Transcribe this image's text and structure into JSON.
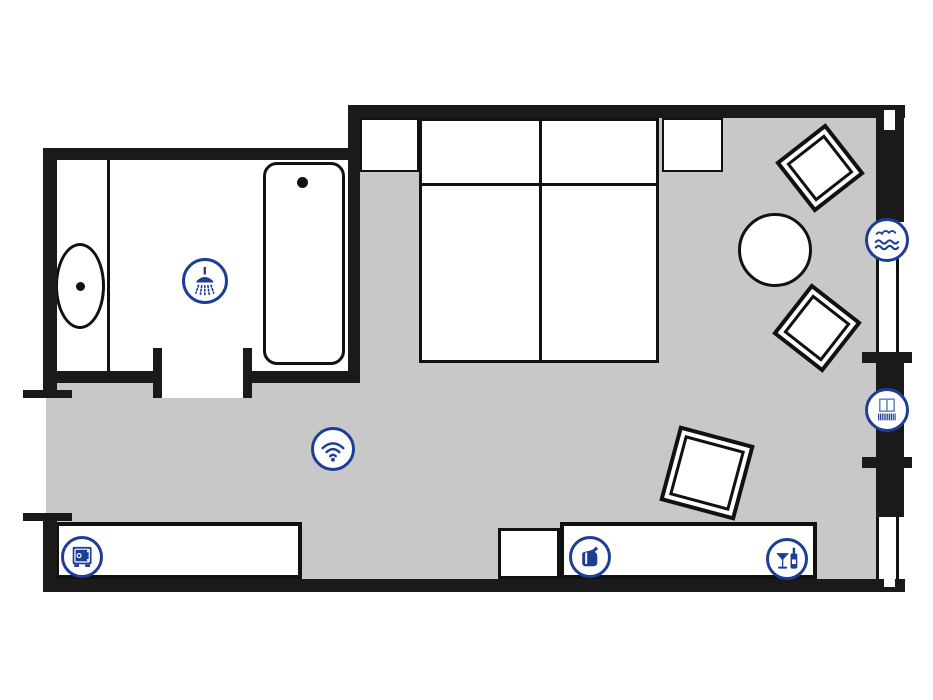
{
  "diagram": {
    "type": "hotel-room-floor-plan",
    "rooms": [
      {
        "id": "bathroom"
      },
      {
        "id": "bedroom"
      },
      {
        "id": "entry-corridor"
      }
    ]
  },
  "colors": {
    "accent": "#1e3e96",
    "wall": "#1a1a1a",
    "floor": "#c8c8c8",
    "line": "#111111",
    "lightblue": "#6b89c6",
    "background": "#ffffff"
  },
  "amenity_icons": [
    {
      "id": "shower",
      "label": "Shower"
    },
    {
      "id": "wifi",
      "label": "Wi-Fi"
    },
    {
      "id": "sea-view",
      "label": "Sea view"
    },
    {
      "id": "balcony",
      "label": "Balcony"
    },
    {
      "id": "safe",
      "label": "Safe"
    },
    {
      "id": "kettle",
      "label": "Kettle"
    },
    {
      "id": "minibar",
      "label": "Minibar"
    }
  ],
  "furniture": [
    {
      "id": "double-bed"
    },
    {
      "id": "nightstand-left"
    },
    {
      "id": "nightstand-right"
    },
    {
      "id": "armchair-1"
    },
    {
      "id": "armchair-2"
    },
    {
      "id": "armchair-3"
    },
    {
      "id": "round-table"
    },
    {
      "id": "bathtub"
    },
    {
      "id": "toilet"
    },
    {
      "id": "sideboard-safe"
    },
    {
      "id": "sideboard-minibar"
    },
    {
      "id": "side-table"
    }
  ]
}
